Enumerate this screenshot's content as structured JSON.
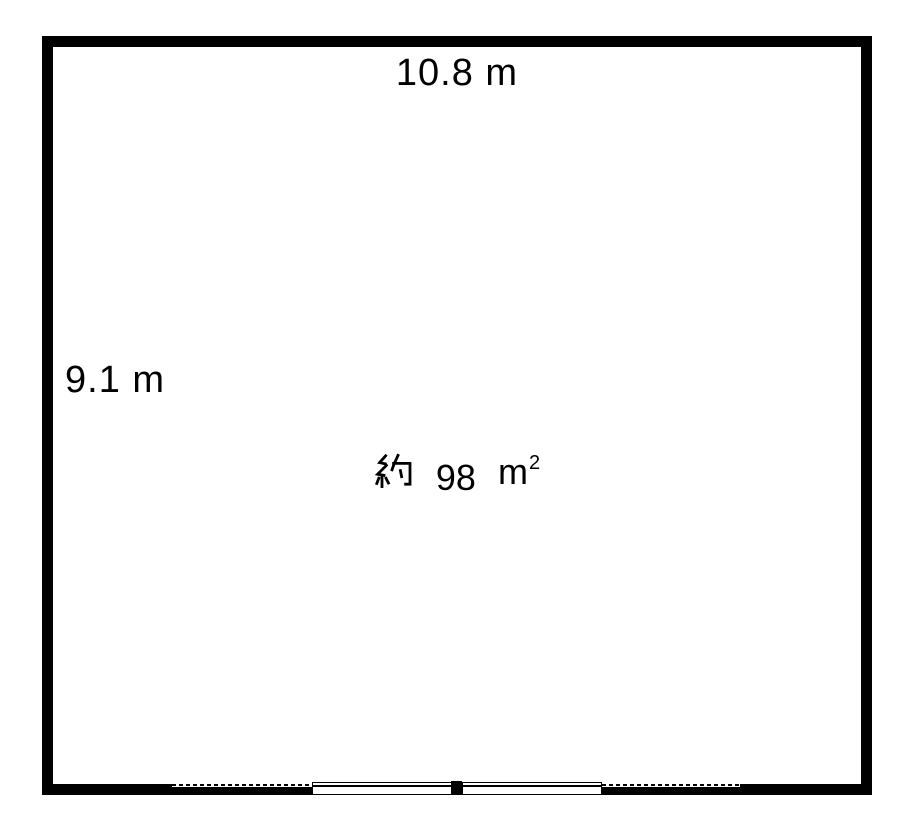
{
  "floor_plan": {
    "top_dimension": "10.8 m",
    "side_dimension": "9.1 m",
    "area": {
      "full_text": "約 98 ㎡",
      "prefix": "約",
      "value": "98",
      "unit_base": "m",
      "unit_exponent": "2"
    },
    "colors": {
      "wall": "#000000",
      "background": "#ffffff"
    }
  }
}
